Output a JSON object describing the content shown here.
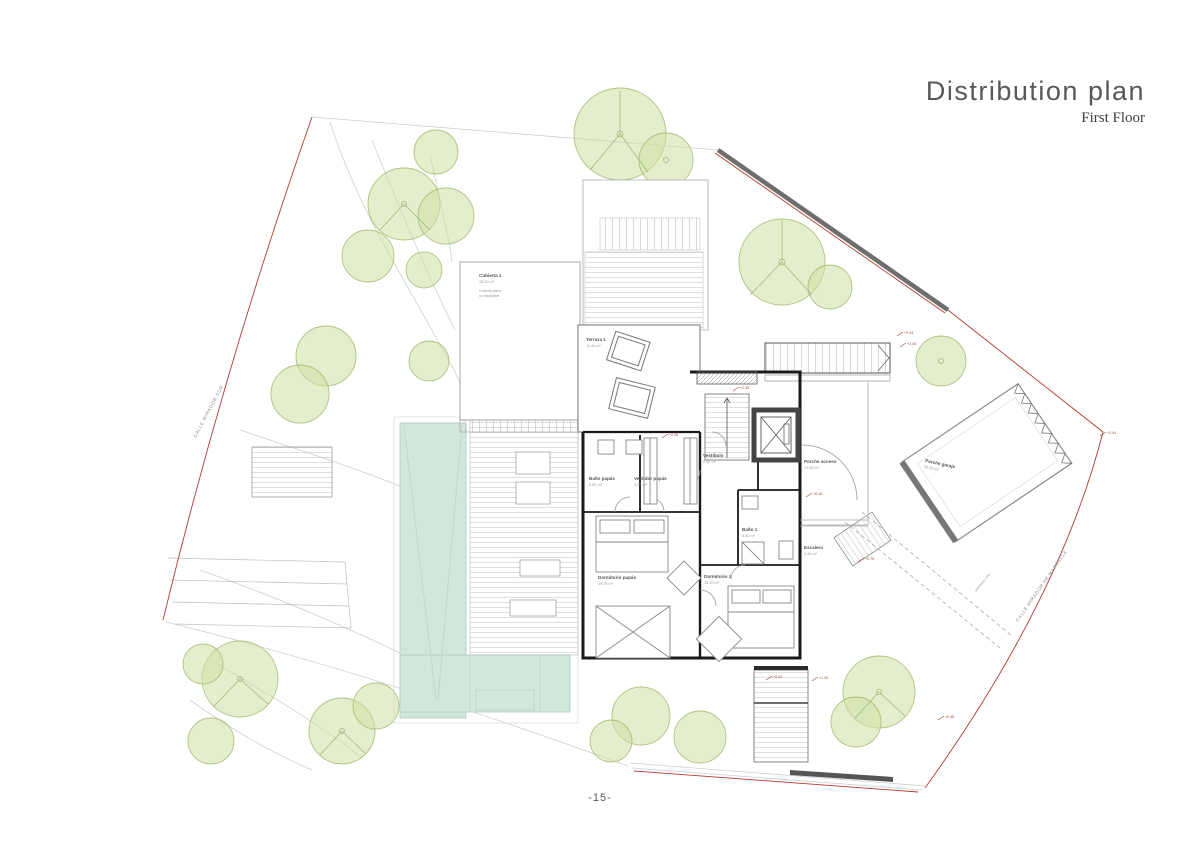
{
  "header": {
    "title": "Distribution plan",
    "subtitle": "First Floor"
  },
  "footer": {
    "page_number": "-15-"
  },
  "plan": {
    "streets": [
      {
        "name": "CALLE MIRADOR SUR"
      },
      {
        "name": "CALLE MIRADOR DE MARBELLA"
      }
    ],
    "slope_label": "pendiente 16%",
    "rooms": [
      {
        "name": "Terraza 1",
        "area": "11.40 m²"
      },
      {
        "name": "Cubierta 1",
        "area": "45.20 m²",
        "note1": "Cubierta plana",
        "note2": "no transitable"
      },
      {
        "name": "Baño papás",
        "area": "6.85 m²"
      },
      {
        "name": "Vestidor papás",
        "area": "4.30 m²"
      },
      {
        "name": "Dormitorio papás",
        "area": "19.75 m²"
      },
      {
        "name": "Vestíbulo",
        "area": "8.40 m²"
      },
      {
        "name": "Baño 1",
        "area": "5.10 m²"
      },
      {
        "name": "Dormitorio 1",
        "area": "15.20 m²"
      },
      {
        "name": "Porche acceso",
        "area": "12.60 m²"
      },
      {
        "name": "Escalera",
        "area": "6.30 m²"
      },
      {
        "name": "Porche garaje",
        "area": "36.50 m²"
      }
    ],
    "levels": [
      "+2.44",
      "+2.44",
      "+2.44",
      "+2.35",
      "+0.15",
      "+2.44",
      "+1.20",
      "+0.48",
      "+0.75",
      "+2.35"
    ]
  }
}
